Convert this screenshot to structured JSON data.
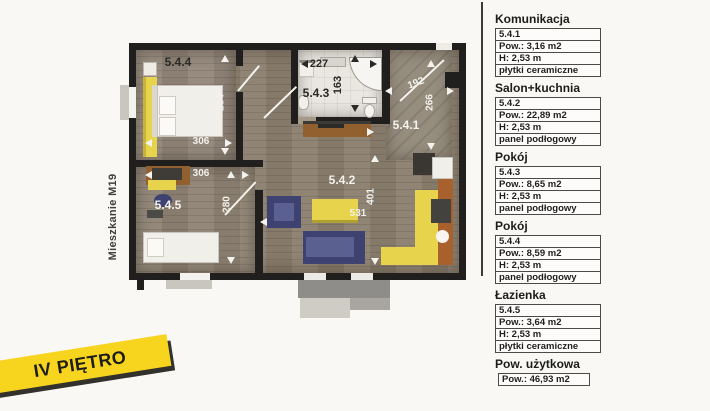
{
  "banner": {
    "label": "IV PIĘTRO"
  },
  "plan": {
    "side_label": "Mieszkanie M19",
    "room_labels": {
      "r1": "5.4.1",
      "r2": "5.4.2",
      "r3": "5.4.3",
      "r4": "5.4.4",
      "r5": "5.4.5"
    },
    "dims": {
      "room4_w": "306",
      "room4_h": "284",
      "room5_w": "306",
      "room5_h": "280",
      "bath_w": "227",
      "bath_h": "163",
      "hall_w": "192",
      "hall_h": "266",
      "salon_h": "401",
      "salon_w": "531"
    }
  },
  "legend": {
    "sections": [
      {
        "title": "Komunikacja",
        "rows": [
          "5.4.1",
          "Pow.: 3,16 m2",
          "H: 2,53 m",
          "płytki ceramiczne"
        ]
      },
      {
        "title": "Salon+kuchnia",
        "rows": [
          "5.4.2",
          "Pow.: 22,89 m2",
          "H: 2,53 m",
          "panel podłogowy"
        ]
      },
      {
        "title": "Pokój",
        "rows": [
          "5.4.3",
          "Pow.: 8,65 m2",
          "H: 2,53 m",
          "panel podłogowy"
        ]
      },
      {
        "title": "Pokój",
        "rows": [
          "5.4.4",
          "Pow.: 8,59 m2",
          "H: 2,53 m",
          "panel podłogowy"
        ]
      },
      {
        "title": "Łazienka",
        "rows": [
          "5.4.5",
          "Pow.: 3,64 m2",
          "H: 2,53 m",
          "płytki ceramiczne"
        ]
      },
      {
        "title": "Pow. użytkowa",
        "rows": [
          "Pow.: 46,93 m2"
        ]
      }
    ]
  },
  "colors": {
    "wall": "#211f1d",
    "wood_floor": "#8c7f6f",
    "bath_floor": "#eae7e1",
    "furniture_yellow": "#e8d44c",
    "furniture_blue": "#3d4271",
    "counter_orange": "#a8602c",
    "banner_yellow": "#f7d51e"
  }
}
